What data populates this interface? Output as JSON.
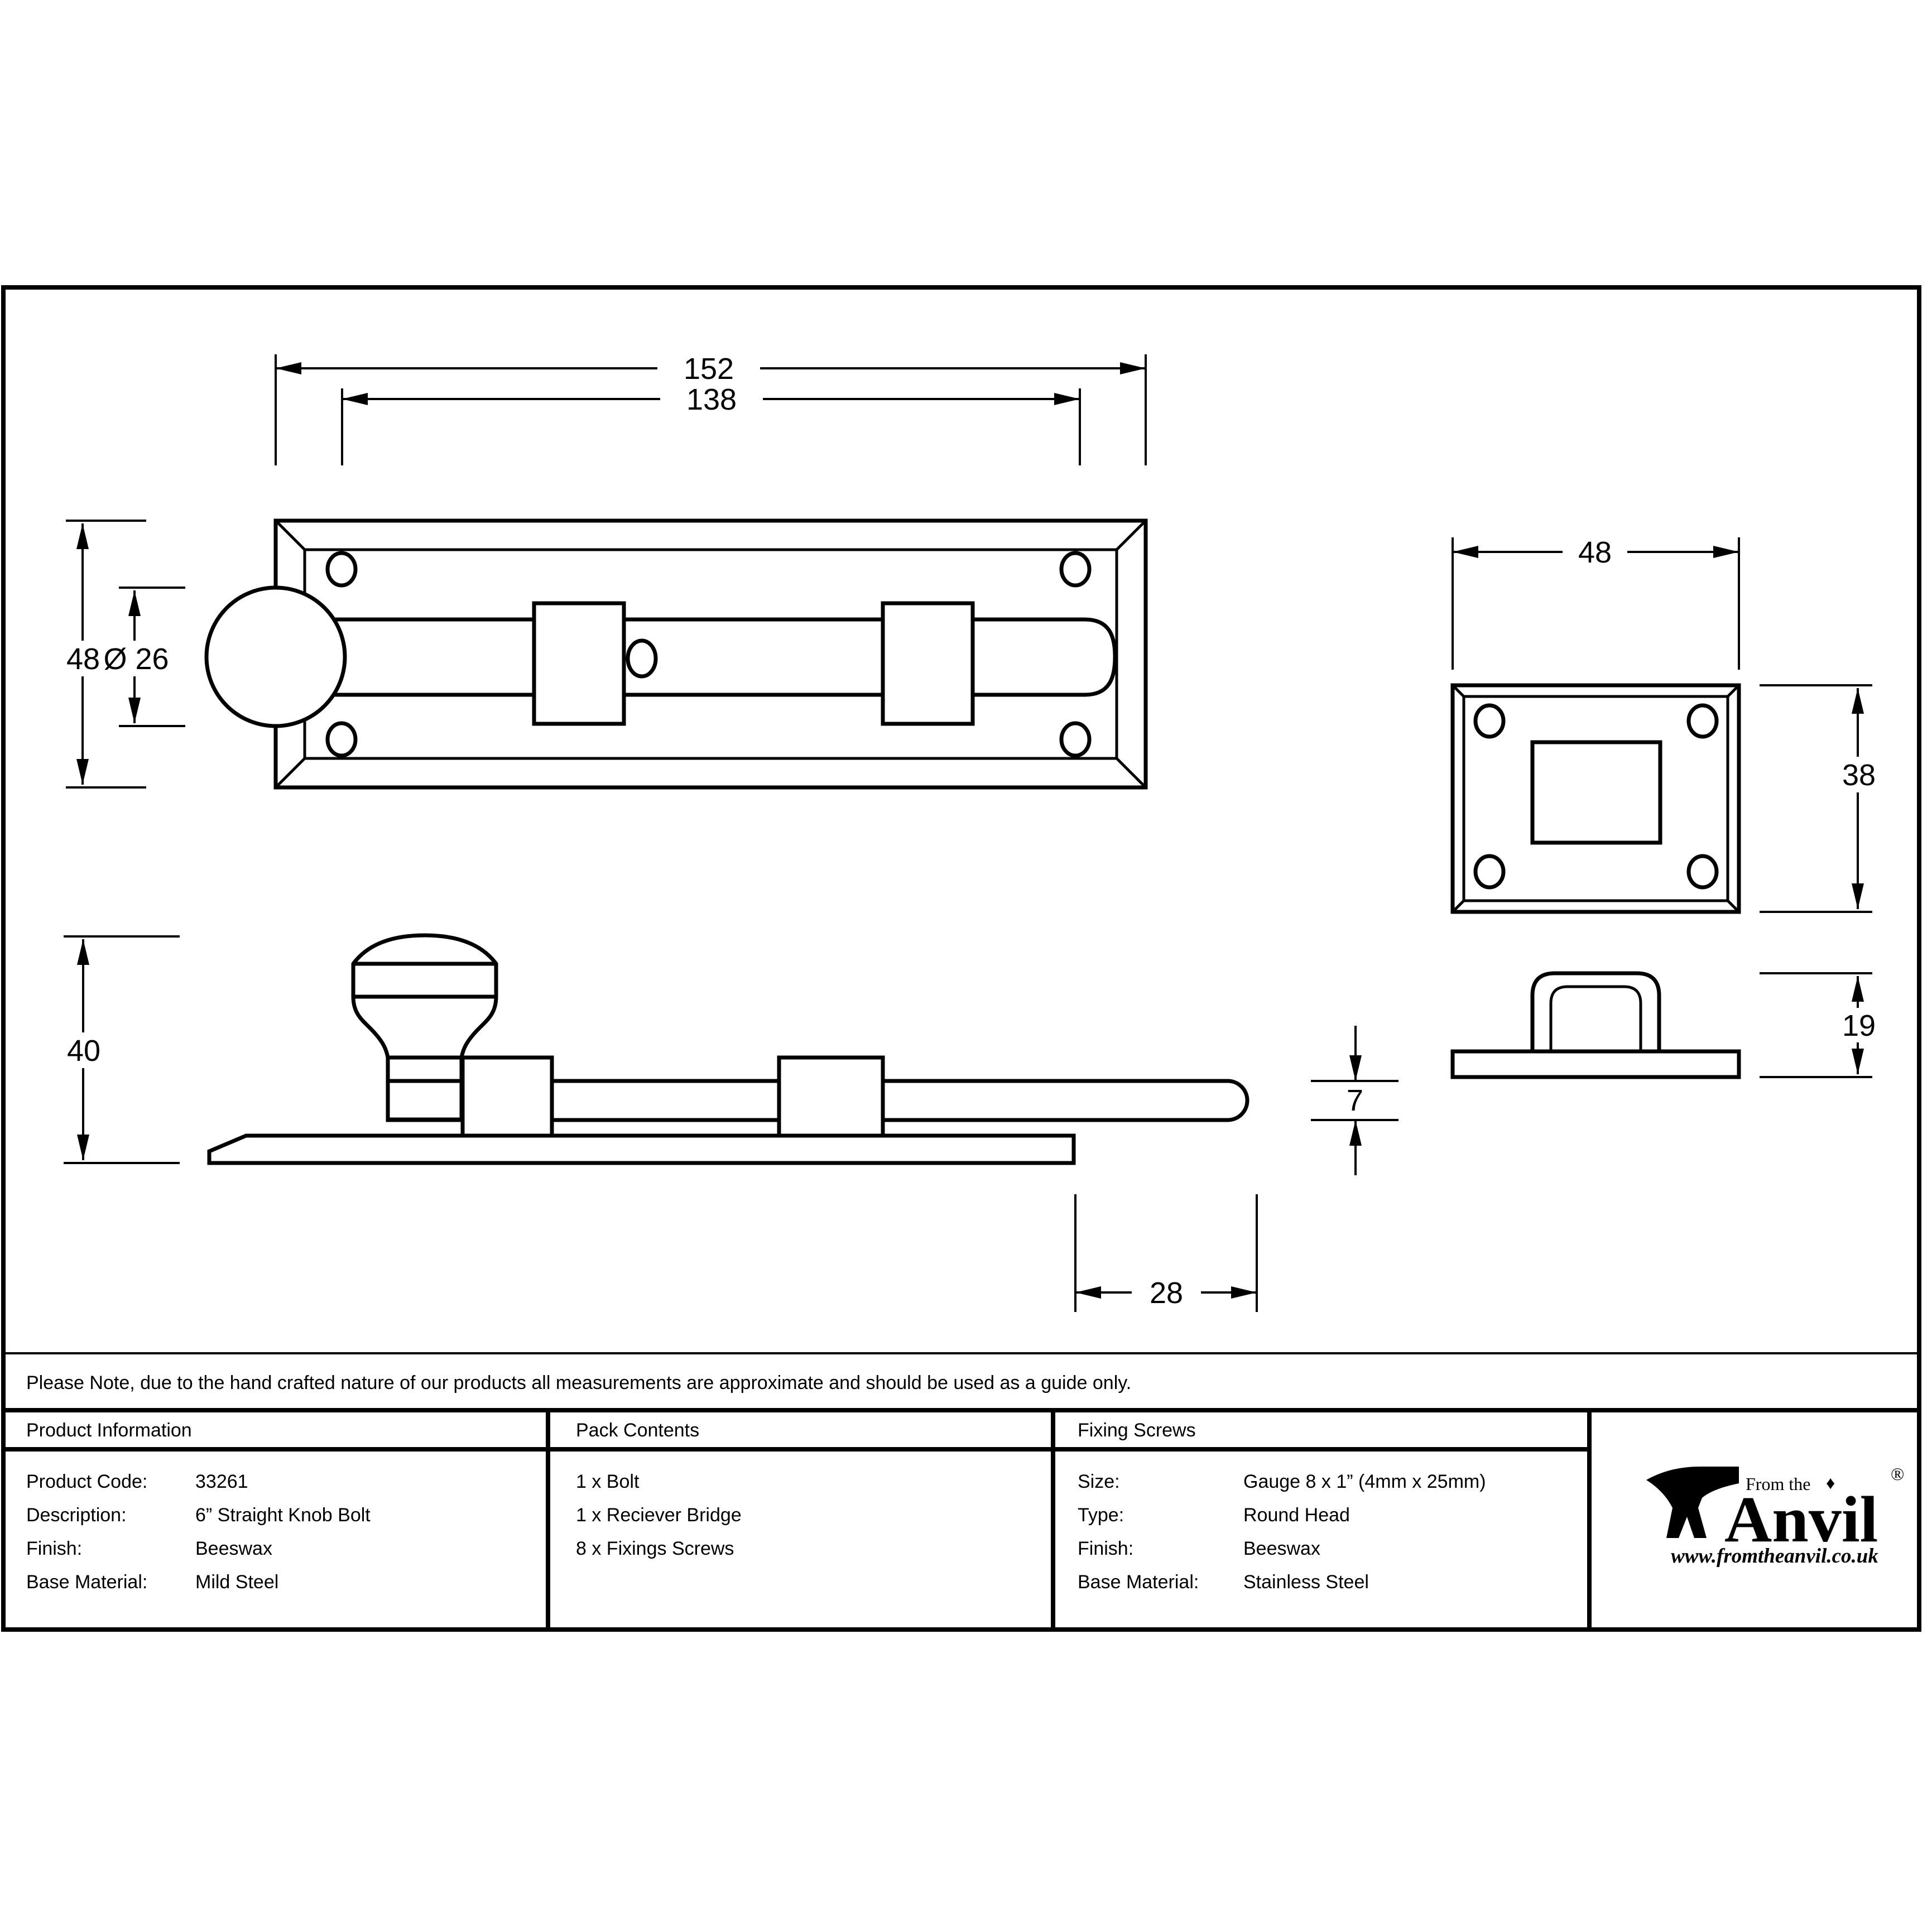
{
  "sheet": {
    "note": "Please Note, due to the hand crafted nature of our products all measurements are approximate and should be used as a guide only."
  },
  "dimensions": {
    "plate_length": "152",
    "fixing_centres": "138",
    "plate_height": "48",
    "knob_diameter": "Ø 26",
    "bridge_width": "48",
    "bridge_height": "38",
    "side_height": "40",
    "rod_thickness": "7",
    "throw": "28",
    "bridge_side_height": "19"
  },
  "table": {
    "product_information": {
      "title": "Product Information",
      "rows": [
        {
          "label": "Product Code:",
          "value": "33261"
        },
        {
          "label": "Description:",
          "value": "6” Straight Knob Bolt"
        },
        {
          "label": "Finish:",
          "value": "Beeswax"
        },
        {
          "label": "Base Material:",
          "value": "Mild Steel"
        }
      ]
    },
    "pack_contents": {
      "title": "Pack Contents",
      "items": [
        "1 x Bolt",
        "1 x Reciever Bridge",
        "8 x Fixings Screws"
      ]
    },
    "fixing_screws": {
      "title": "Fixing Screws",
      "rows": [
        {
          "label": "Size:",
          "value": "Gauge 8 x 1” (4mm x 25mm)"
        },
        {
          "label": "Type:",
          "value": "Round Head"
        },
        {
          "label": "Finish:",
          "value": "Beeswax"
        },
        {
          "label": "Base Material:",
          "value": "Stainless Steel"
        }
      ]
    }
  },
  "logo": {
    "tagline": "From the",
    "diamond": "♦",
    "brand": "Anvil",
    "registered": "®",
    "url": "www.fromtheanvil.co.uk"
  }
}
